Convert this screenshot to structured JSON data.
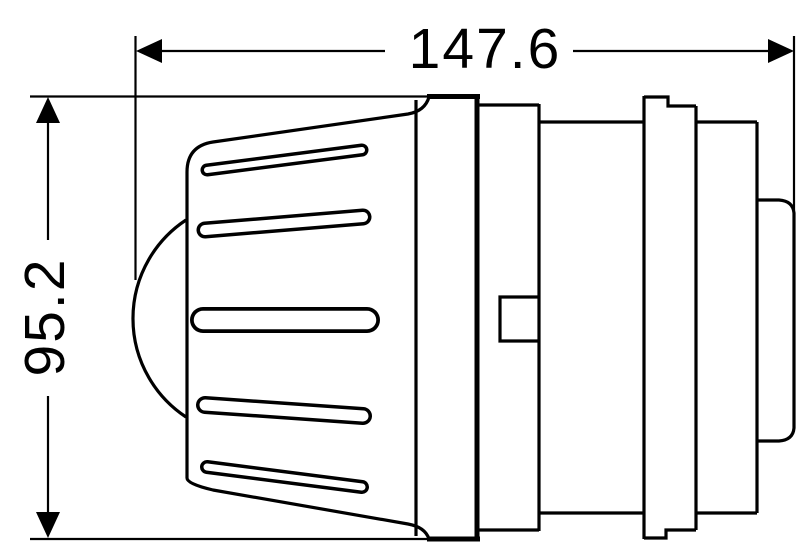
{
  "drawing": {
    "type": "technical-dimension-drawing",
    "background_color": "#ffffff",
    "line_color": "#000000",
    "dimensions": {
      "horizontal": {
        "value": "147.6",
        "orientation": "horizontal",
        "measures": "overall-length"
      },
      "vertical": {
        "value": "95.2",
        "orientation": "vertical",
        "measures": "cap-diameter"
      }
    }
  }
}
